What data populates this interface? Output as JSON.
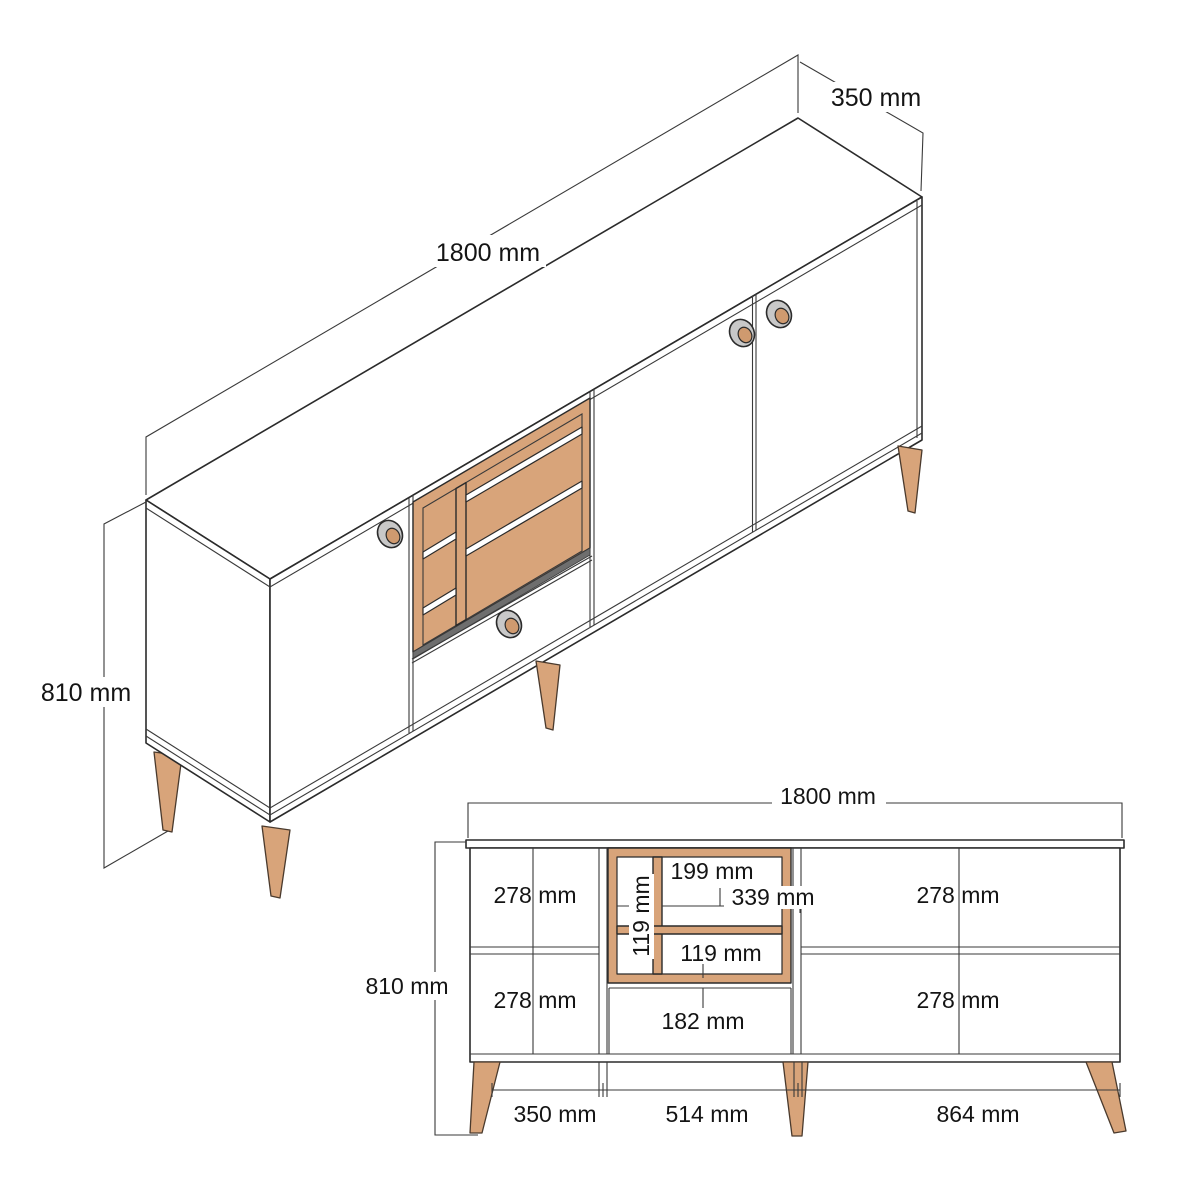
{
  "drawing": {
    "kind": "furniture-dimension-drawing",
    "item": "sideboard with open shelf, doors and drawer",
    "views": [
      "isometric",
      "front-elevation"
    ]
  },
  "colors": {
    "line": "#2b2b2b",
    "wood": "#d8a47a",
    "wood_deep": "#cf9a6f",
    "knob_ring": "#c8c8c8",
    "shelf_shadow": "#6e6e6e",
    "background": "#ffffff"
  },
  "iso": {
    "width_label": "1800 mm",
    "depth_label": "350 mm",
    "height_label": "810 mm"
  },
  "front": {
    "width_label": "1800 mm",
    "height_label": "810 mm",
    "compartments": {
      "top_left": "278 mm",
      "bottom_left": "278 mm",
      "top_right": "278 mm",
      "bottom_right": "278 mm"
    },
    "shelf": {
      "top": "199 mm",
      "right": "339 mm",
      "column": "119 mm",
      "bottom": "119 mm"
    },
    "drawer_label": "182 mm",
    "bottom": {
      "left": "350 mm",
      "middle": "514 mm",
      "right": "864 mm"
    }
  }
}
